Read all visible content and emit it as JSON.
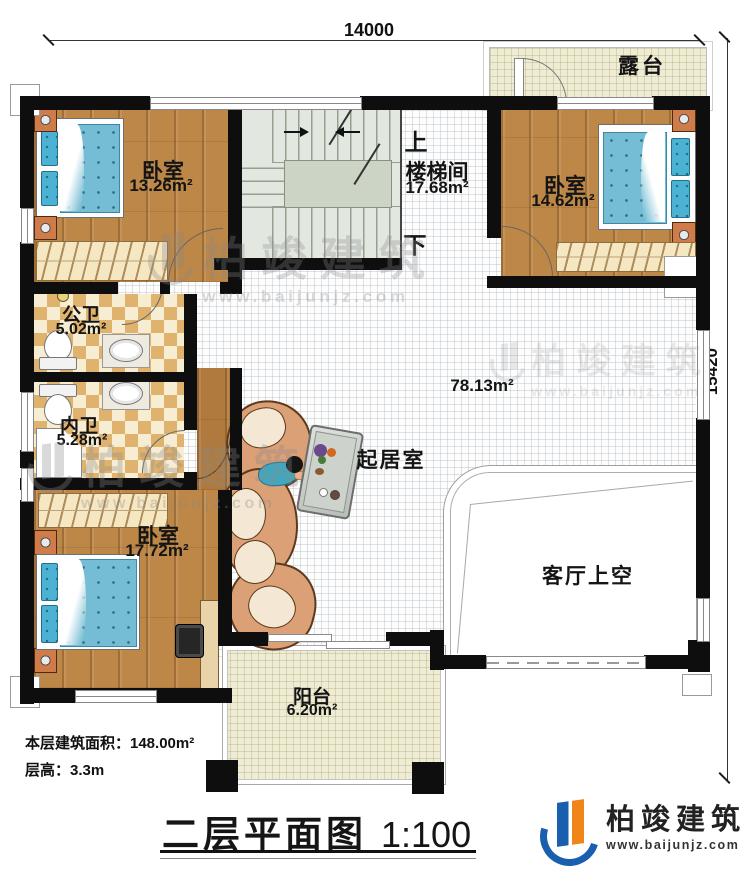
{
  "dimensions": {
    "width_top": "14000",
    "height_right": "15420"
  },
  "rooms": {
    "terrace": {
      "name": "露台"
    },
    "bedroom_tl": {
      "name": "卧室",
      "area": "13.26m²"
    },
    "stair": {
      "name": "楼梯间",
      "area": "17.68m²",
      "up": "上",
      "down": "下"
    },
    "bedroom_tr": {
      "name": "卧室",
      "area": "14.62m²"
    },
    "bath_public": {
      "name": "公卫",
      "area": "5.02m²"
    },
    "bath_inner": {
      "name": "内卫",
      "area": "5.28m²"
    },
    "bedroom_bl": {
      "name": "卧室",
      "area": "17.72m²"
    },
    "living": {
      "name": "起居室",
      "area": "78.13m²"
    },
    "void": {
      "name": "客厅上空"
    },
    "balcony": {
      "name": "阳台",
      "area": "6.20m²"
    }
  },
  "notes": {
    "floor_area": "本层建筑面积：148.00m²",
    "floor_height": "层高：3.3m"
  },
  "title": {
    "name": "二层平面图",
    "scale": "1:100"
  },
  "brand": {
    "name": "柏竣建筑",
    "website": "www.baijunjz.com"
  },
  "watermark": {
    "name": "柏竣建筑",
    "website": "www.baijunjz.com"
  },
  "colors": {
    "wall": "#0e0e0e",
    "wood": "#bd8748",
    "bed": "#74bdd4",
    "checker": "#dfb26e",
    "cream": "#efecd6",
    "brand_blue": "#1a5fae",
    "brand_orange": "#f08519"
  }
}
